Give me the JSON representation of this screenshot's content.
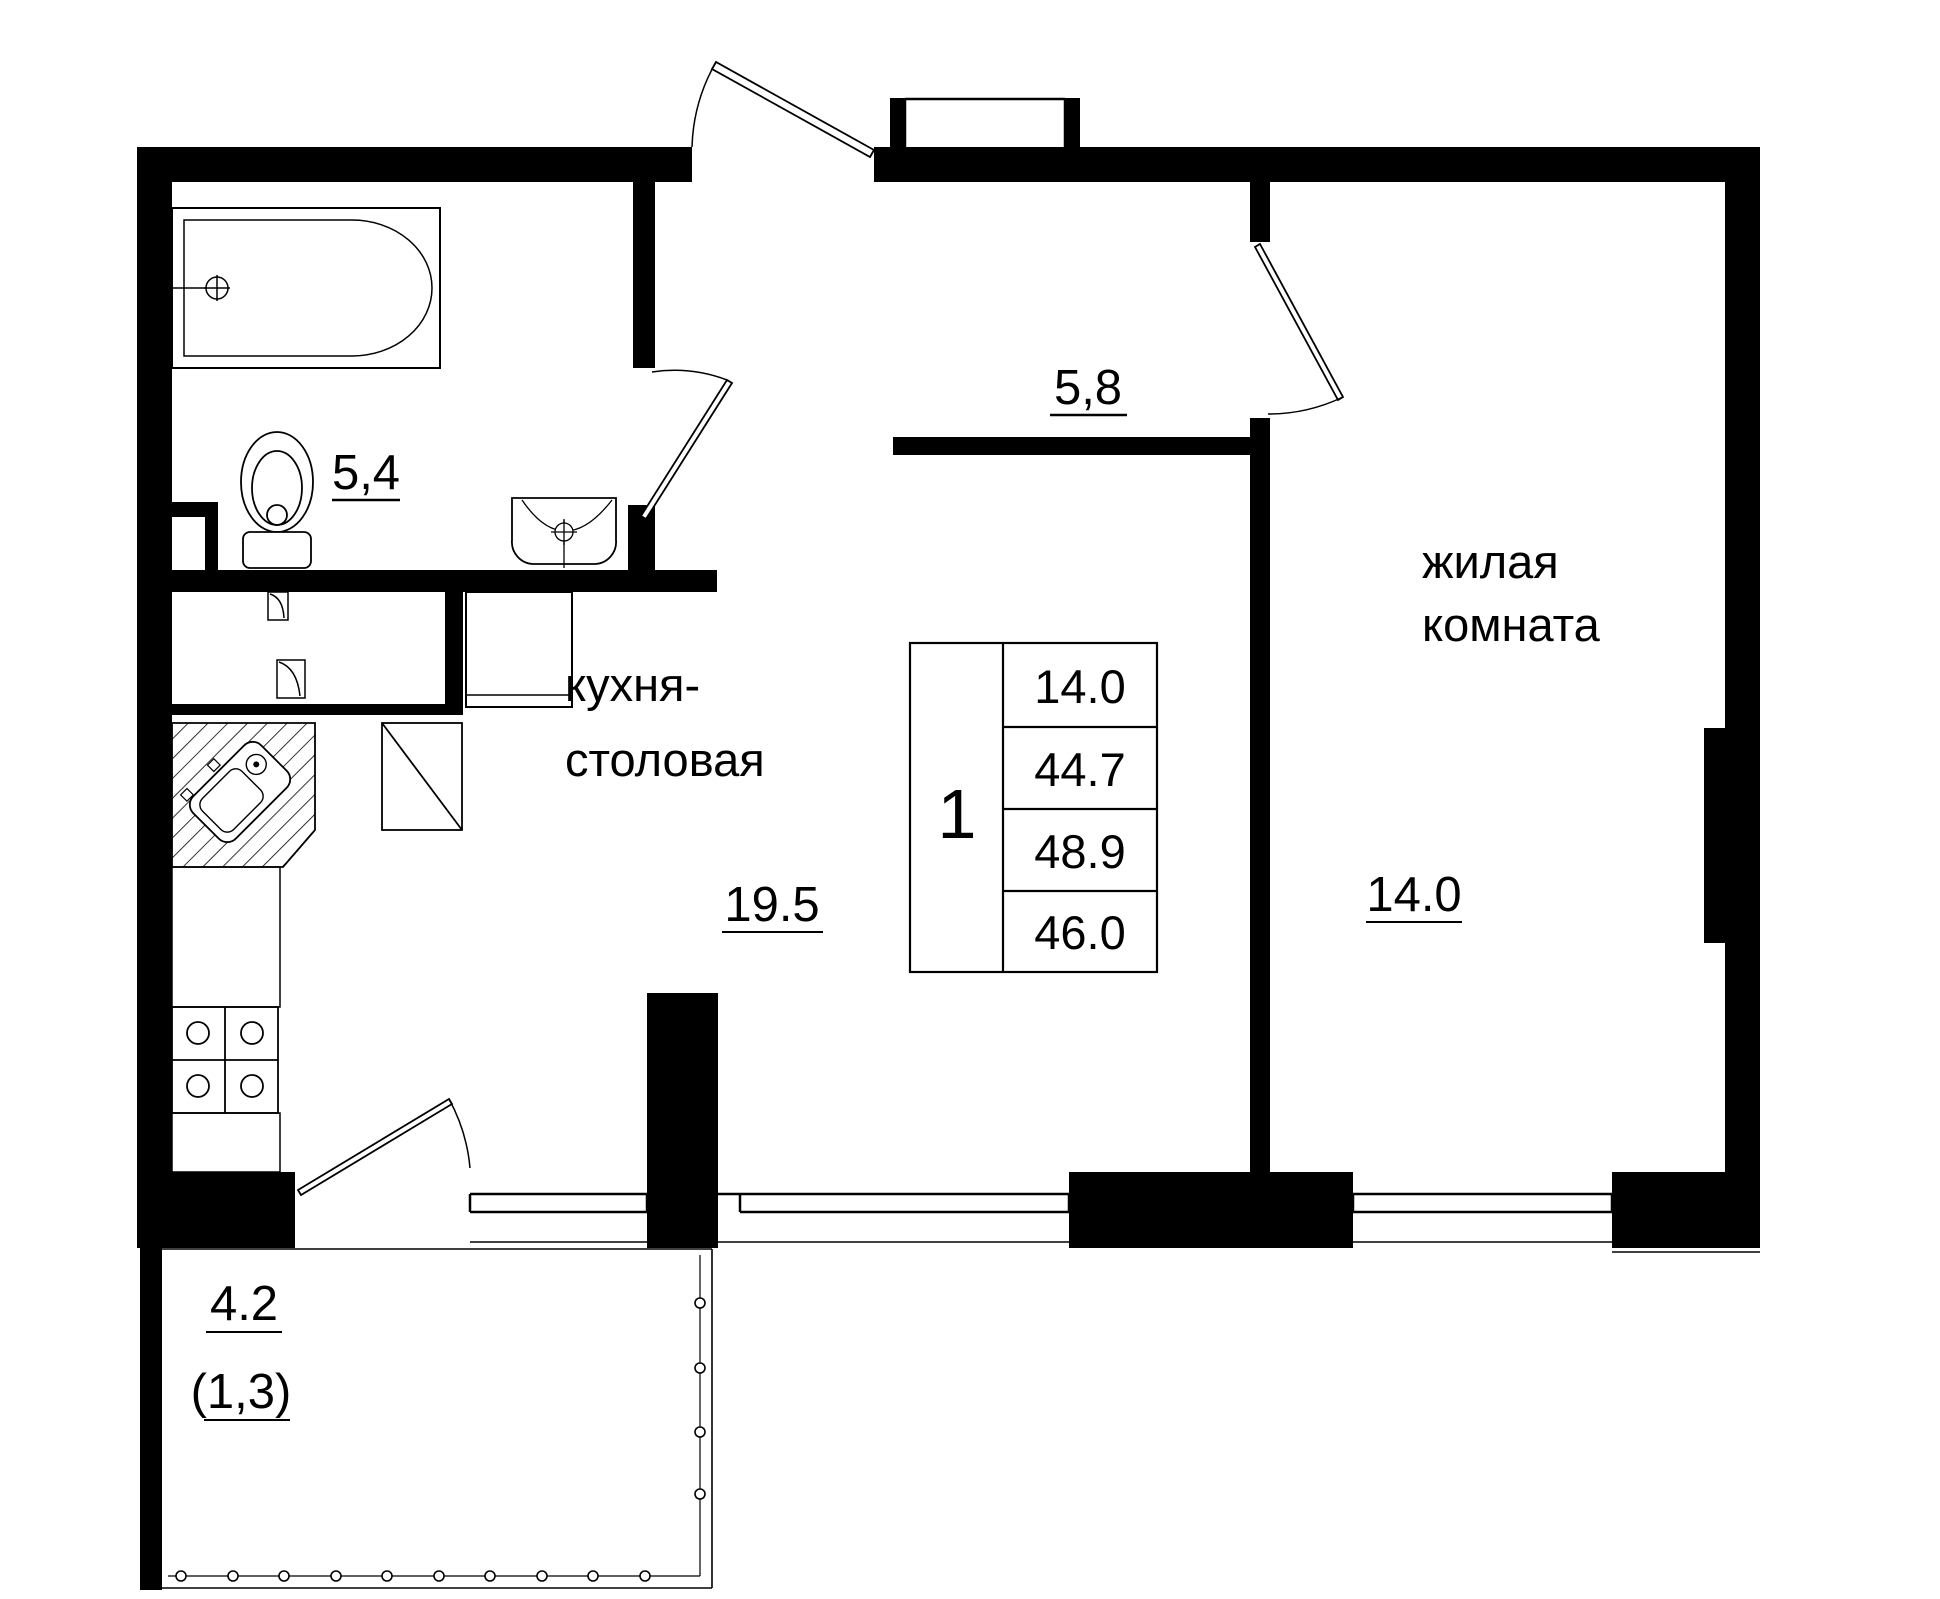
{
  "plan_title": "apartment floor plan",
  "rooms": {
    "bathroom": {
      "area_label": "5,4"
    },
    "hallway": {
      "area_label": "5,8"
    },
    "kitchen_dining": {
      "name_line1": "кухня-",
      "name_line2": "столовая",
      "area_label": "19.5"
    },
    "living_room": {
      "name_line1": "жилая",
      "name_line2": "комната",
      "area_label": "14.0"
    },
    "balcony": {
      "area_label": "4.2",
      "area_coefficient_label": "(1,3)"
    }
  },
  "info_table": {
    "rooms_count": "1",
    "values": [
      "14.0",
      "44.7",
      "48.9",
      "46.0"
    ]
  },
  "colors": {
    "walls": "#000000",
    "lines": "#000000",
    "background": "#ffffff"
  }
}
